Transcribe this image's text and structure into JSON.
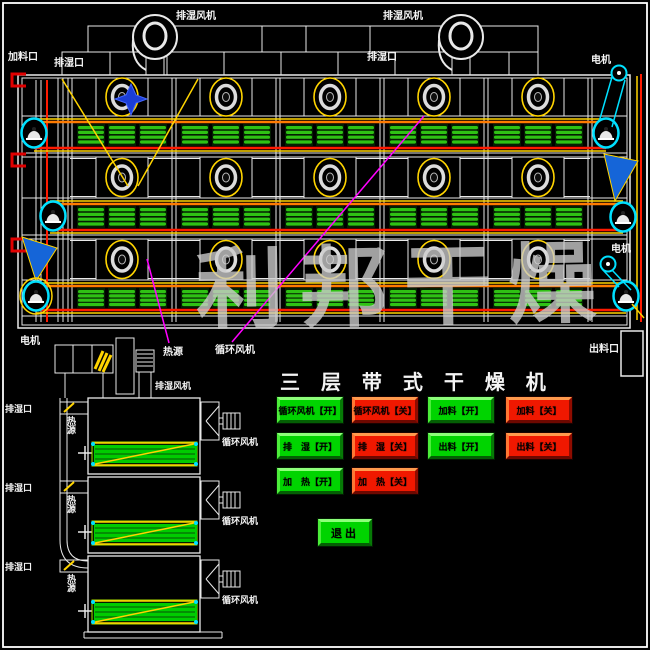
{
  "watermark": "利邦干燥",
  "panel": {
    "title": "三 层 带 式 干 燥 机",
    "exit_label": "退出",
    "buttons": {
      "rows": [
        {
          "items": [
            {
              "label": "循环风机【开】",
              "state": "on"
            },
            {
              "label": "循环风机【关】",
              "state": "off"
            },
            {
              "label": "加料【开】",
              "state": "on"
            },
            {
              "label": "加料【关】",
              "state": "off"
            }
          ]
        },
        {
          "items": [
            {
              "label": "排　湿【开】",
              "state": "on"
            },
            {
              "label": "排　湿【关】",
              "state": "off"
            },
            {
              "label": "出料【开】",
              "state": "on"
            },
            {
              "label": "出料【关】",
              "state": "off"
            }
          ]
        },
        {
          "items": [
            {
              "label": "加　热【开】",
              "state": "on"
            },
            {
              "label": "加　热【关】",
              "state": "off"
            }
          ]
        }
      ]
    }
  },
  "labels": {
    "exhaust_fan": "排湿风机",
    "feed_port": "加料口",
    "exhaust_port": "排湿口",
    "motor": "电机",
    "heat_source": "热源",
    "circulation_fan": "循环风机",
    "discharge_port": "出料口"
  },
  "colors": {
    "background": "#000000",
    "line_white": "#e9e9e9",
    "yellow": "#ffd400",
    "orange": "#ff7b00",
    "red": "#ff1a00",
    "belt_green": "#2fc214",
    "side_belt_green": "#00cc00",
    "cyan": "#00e0ff",
    "blue": "#1565d8",
    "magenta": "#ff00ff",
    "button_on": "#00d400",
    "button_off": "#f01800",
    "watermark_gray": "#cdcdcd"
  }
}
